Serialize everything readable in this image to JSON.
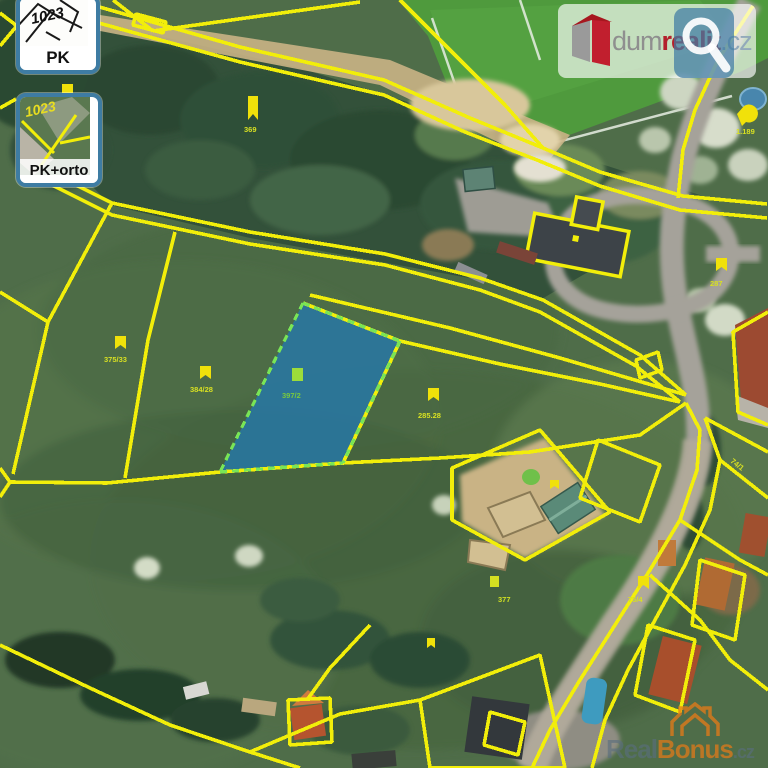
{
  "map_controls": {
    "pk": {
      "label": "PK",
      "sketch_number": "1023"
    },
    "pk_orto": {
      "label": "PK+orto",
      "sketch_number": "1023"
    }
  },
  "branding": {
    "dum": "dum",
    "realit": "realit",
    "cz": ".cz"
  },
  "watermark": {
    "real": "Real",
    "bonus": "Bonus",
    "cz": ".cz"
  },
  "highlighted_parcel": {
    "number": "397/2",
    "fill_color": "#2678a8",
    "border_color": "#79e556"
  },
  "overlay": {
    "line_color": "#f2ee0a"
  },
  "parcel_labels": [
    {
      "text": "375/33",
      "color": "#d8e022"
    },
    {
      "text": "384/28",
      "color": "#d8e022"
    },
    {
      "text": "397/2",
      "color": "#79c93e"
    },
    {
      "text": "285.28",
      "color": "#d8e022"
    },
    {
      "text": "369",
      "color": "#d8e022"
    },
    {
      "text": "1.189",
      "color": "#d8e022"
    },
    {
      "text": "287",
      "color": "#d8e022"
    },
    {
      "text": "377",
      "color": "#cfe021"
    },
    {
      "text": "75/4",
      "color": "#d8e022"
    },
    {
      "text": "74/1",
      "color": "#d8e022"
    }
  ]
}
